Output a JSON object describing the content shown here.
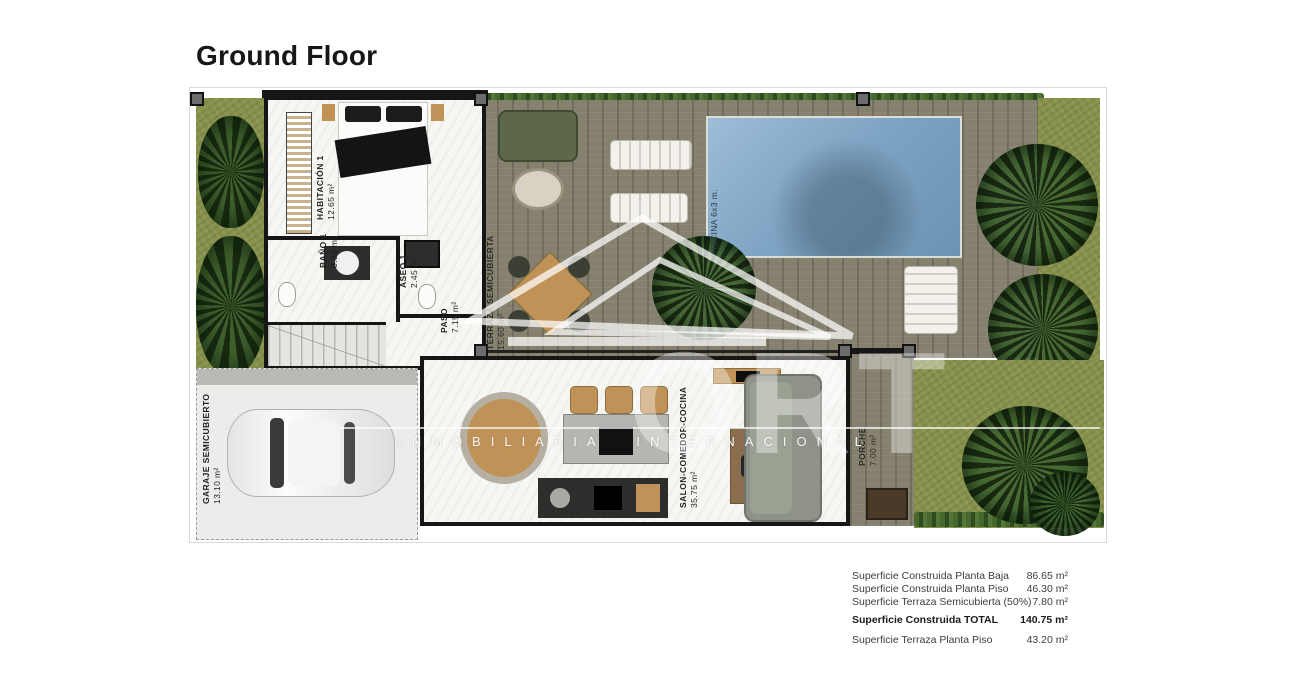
{
  "page": {
    "title": "Ground Floor"
  },
  "plan": {
    "rooms": [
      {
        "label": "HABITACIÓN 1",
        "area": "12.65 m²"
      },
      {
        "label": "BAÑO 1",
        "area": "3.35 m²"
      },
      {
        "label": "ASEO 1",
        "area": "2.45 m²"
      },
      {
        "label": "PASO",
        "area": "7.15 m²"
      },
      {
        "label": "TERRAZA SEMICUBIERTA",
        "area": "15.60 m²"
      },
      {
        "label": "PISCINA 6x3 m.",
        "area": ""
      },
      {
        "label": "SALON-COMEDOR-COCINA",
        "area": "35.75 m²"
      },
      {
        "label": "PORCHE",
        "area": "7.00 m²"
      },
      {
        "label": "GARAJE SEMICUBIERTO",
        "area": "13.10 m²"
      }
    ]
  },
  "watermark": {
    "tagline": "INMOBILIARIA INTERNACIONAL",
    "large_text": "ORT"
  },
  "summary": {
    "rows": [
      {
        "label": "Superficie Construida Planta Baja",
        "value": "86.65 m²"
      },
      {
        "label": "Superficie Construida Planta Piso",
        "value": "46.30 m²"
      },
      {
        "label": "Superficie Terraza Semicubierta (50%)",
        "value": "7.80 m²"
      },
      {
        "label": "Superficie Construida TOTAL",
        "value": "140.75 m²"
      },
      {
        "label": "Superficie Terraza Planta Piso",
        "value": "43.20 m²"
      }
    ]
  },
  "colors": {
    "wall": "#161616",
    "pool": "#7da3c2",
    "deck": "#86806f",
    "grass": "#87914a",
    "hedge": "#3f6030",
    "floor": "#f6f6f3",
    "wood_furniture": "#c09257"
  }
}
